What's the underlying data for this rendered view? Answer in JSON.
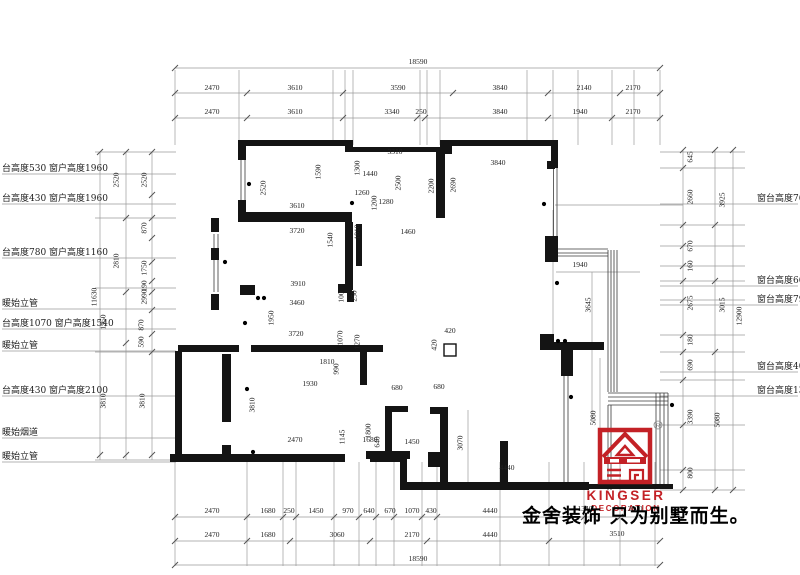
{
  "slogan": "金舍装饰 只为别墅而生。",
  "logo": {
    "brand": "KINGSER",
    "subtitle": "DECORATION",
    "registered": "R",
    "color": "#c32126"
  },
  "dims": {
    "top": [
      {
        "t": "18590",
        "x": 418,
        "y": 62
      },
      {
        "t": "2470",
        "x": 212,
        "y": 88
      },
      {
        "t": "3610",
        "x": 295,
        "y": 88
      },
      {
        "t": "3590",
        "x": 398,
        "y": 88
      },
      {
        "t": "3840",
        "x": 500,
        "y": 88
      },
      {
        "t": "2140",
        "x": 584,
        "y": 88
      },
      {
        "t": "2170",
        "x": 633,
        "y": 88
      },
      {
        "t": "2470",
        "x": 212,
        "y": 112
      },
      {
        "t": "3610",
        "x": 295,
        "y": 112
      },
      {
        "t": "3340",
        "x": 392,
        "y": 112
      },
      {
        "t": "250",
        "x": 421,
        "y": 112
      },
      {
        "t": "3840",
        "x": 500,
        "y": 112
      },
      {
        "t": "1940",
        "x": 580,
        "y": 112
      },
      {
        "t": "2170",
        "x": 633,
        "y": 112
      }
    ],
    "bottom": [
      {
        "t": "2470",
        "x": 212,
        "y": 511
      },
      {
        "t": "1680",
        "x": 268,
        "y": 511
      },
      {
        "t": "250",
        "x": 289,
        "y": 511
      },
      {
        "t": "1450",
        "x": 316,
        "y": 511
      },
      {
        "t": "970",
        "x": 348,
        "y": 511
      },
      {
        "t": "640",
        "x": 369,
        "y": 511
      },
      {
        "t": "670",
        "x": 390,
        "y": 511
      },
      {
        "t": "1070",
        "x": 412,
        "y": 511
      },
      {
        "t": "430",
        "x": 431,
        "y": 511
      },
      {
        "t": "4440",
        "x": 490,
        "y": 511
      },
      {
        "t": "1340",
        "x": 585,
        "y": 509
      },
      {
        "t": "2000",
        "x": 635,
        "y": 509
      },
      {
        "t": "2470",
        "x": 212,
        "y": 535
      },
      {
        "t": "1680",
        "x": 268,
        "y": 535
      },
      {
        "t": "3060",
        "x": 337,
        "y": 535
      },
      {
        "t": "2170",
        "x": 412,
        "y": 535
      },
      {
        "t": "4440",
        "x": 490,
        "y": 535
      },
      {
        "t": "3510",
        "x": 617,
        "y": 534
      },
      {
        "t": "18590",
        "x": 418,
        "y": 559
      }
    ],
    "left": [
      {
        "t": "11630",
        "x": 94,
        "y": 297,
        "r": 1
      },
      {
        "t": "2520",
        "x": 116,
        "y": 180,
        "r": 1
      },
      {
        "t": "2810",
        "x": 116,
        "y": 261,
        "r": 1
      },
      {
        "t": "1950",
        "x": 103,
        "y": 322,
        "r": 1
      },
      {
        "t": "3810",
        "x": 103,
        "y": 401,
        "r": 1
      },
      {
        "t": "2520",
        "x": 144,
        "y": 180,
        "r": 1
      },
      {
        "t": "870",
        "x": 144,
        "y": 228,
        "r": 1
      },
      {
        "t": "1750",
        "x": 144,
        "y": 268,
        "r": 1
      },
      {
        "t": "190",
        "x": 144,
        "y": 286,
        "r": 1
      },
      {
        "t": "2990",
        "x": 144,
        "y": 297,
        "r": 1
      },
      {
        "t": "870",
        "x": 141,
        "y": 325,
        "r": 1
      },
      {
        "t": "590",
        "x": 141,
        "y": 342,
        "r": 1
      },
      {
        "t": "3810",
        "x": 142,
        "y": 401,
        "r": 1
      }
    ],
    "right": [
      {
        "t": "645",
        "x": 690,
        "y": 157,
        "r": 1
      },
      {
        "t": "2660",
        "x": 690,
        "y": 197,
        "r": 1
      },
      {
        "t": "670",
        "x": 690,
        "y": 246,
        "r": 1
      },
      {
        "t": "160",
        "x": 690,
        "y": 266,
        "r": 1
      },
      {
        "t": "2675",
        "x": 690,
        "y": 303,
        "r": 1
      },
      {
        "t": "180",
        "x": 690,
        "y": 340,
        "r": 1
      },
      {
        "t": "690",
        "x": 690,
        "y": 365,
        "r": 1
      },
      {
        "t": "3390",
        "x": 690,
        "y": 417,
        "r": 1
      },
      {
        "t": "800",
        "x": 690,
        "y": 473,
        "r": 1
      },
      {
        "t": "3925",
        "x": 722,
        "y": 200,
        "r": 1
      },
      {
        "t": "3015",
        "x": 722,
        "y": 305,
        "r": 1
      },
      {
        "t": "5080",
        "x": 717,
        "y": 420,
        "r": 1
      },
      {
        "t": "12900",
        "x": 739,
        "y": 316,
        "r": 1
      }
    ],
    "interior": [
      {
        "t": "3310",
        "x": 395,
        "y": 152
      },
      {
        "t": "3840",
        "x": 498,
        "y": 163
      },
      {
        "t": "1440",
        "x": 370,
        "y": 174
      },
      {
        "t": "1260",
        "x": 362,
        "y": 193
      },
      {
        "t": "1280",
        "x": 386,
        "y": 202
      },
      {
        "t": "3610",
        "x": 297,
        "y": 206
      },
      {
        "t": "3720",
        "x": 297,
        "y": 231
      },
      {
        "t": "1460",
        "x": 408,
        "y": 232
      },
      {
        "t": "3910",
        "x": 298,
        "y": 284
      },
      {
        "t": "3460",
        "x": 297,
        "y": 303
      },
      {
        "t": "3720",
        "x": 296,
        "y": 334
      },
      {
        "t": "1810",
        "x": 327,
        "y": 362
      },
      {
        "t": "1930",
        "x": 310,
        "y": 384
      },
      {
        "t": "680",
        "x": 397,
        "y": 388
      },
      {
        "t": "680",
        "x": 439,
        "y": 387
      },
      {
        "t": "2470",
        "x": 295,
        "y": 440
      },
      {
        "t": "1680",
        "x": 370,
        "y": 440
      },
      {
        "t": "1450",
        "x": 412,
        "y": 442
      },
      {
        "t": "4440",
        "x": 507,
        "y": 468
      },
      {
        "t": "1940",
        "x": 580,
        "y": 265
      },
      {
        "t": "420",
        "x": 450,
        "y": 331
      },
      {
        "t": "2520",
        "x": 263,
        "y": 188,
        "r": 1
      },
      {
        "t": "1590",
        "x": 318,
        "y": 172,
        "r": 1
      },
      {
        "t": "1300",
        "x": 357,
        "y": 168,
        "r": 1
      },
      {
        "t": "1200",
        "x": 374,
        "y": 203,
        "r": 1
      },
      {
        "t": "2500",
        "x": 398,
        "y": 183,
        "r": 1
      },
      {
        "t": "2200",
        "x": 431,
        "y": 186,
        "r": 1
      },
      {
        "t": "2690",
        "x": 453,
        "y": 185,
        "r": 1
      },
      {
        "t": "1540",
        "x": 330,
        "y": 240,
        "r": 1
      },
      {
        "t": "1810",
        "x": 357,
        "y": 232,
        "r": 1
      },
      {
        "t": "250",
        "x": 354,
        "y": 296,
        "r": 1
      },
      {
        "t": "100",
        "x": 341,
        "y": 297,
        "r": 1
      },
      {
        "t": "1950",
        "x": 271,
        "y": 318,
        "r": 1
      },
      {
        "t": "1070",
        "x": 340,
        "y": 338,
        "r": 1
      },
      {
        "t": "1270",
        "x": 357,
        "y": 342,
        "r": 1
      },
      {
        "t": "990",
        "x": 336,
        "y": 369,
        "r": 1
      },
      {
        "t": "3810",
        "x": 252,
        "y": 405,
        "r": 1
      },
      {
        "t": "1145",
        "x": 342,
        "y": 437,
        "r": 1
      },
      {
        "t": "1800",
        "x": 368,
        "y": 431,
        "r": 1
      },
      {
        "t": "640",
        "x": 377,
        "y": 442,
        "r": 1
      },
      {
        "t": "420",
        "x": 434,
        "y": 345,
        "r": 1
      },
      {
        "t": "3070",
        "x": 460,
        "y": 443,
        "r": 1
      },
      {
        "t": "5080",
        "x": 593,
        "y": 418,
        "r": 1
      },
      {
        "t": "3645",
        "x": 588,
        "y": 305,
        "r": 1
      }
    ]
  },
  "side_notes": {
    "left": [
      {
        "t": "台高度530 窗户高度1960",
        "x": 2,
        "y": 168
      },
      {
        "t": "台高度430 窗户高度1960",
        "x": 2,
        "y": 198
      },
      {
        "t": "台高度780 窗户高度1160",
        "x": 2,
        "y": 252
      },
      {
        "t": "暖始立管",
        "x": 2,
        "y": 303
      },
      {
        "t": "台高度1070 窗户高度1540",
        "x": 2,
        "y": 323
      },
      {
        "t": "暖始立管",
        "x": 2,
        "y": 345
      },
      {
        "t": "台高度430 窗户高度2100",
        "x": 2,
        "y": 390
      },
      {
        "t": "暖始烟道",
        "x": 2,
        "y": 432
      },
      {
        "t": "暖始立管",
        "x": 2,
        "y": 456
      }
    ],
    "right": [
      {
        "t": "窗台高度760",
        "x": 757,
        "y": 198
      },
      {
        "t": "窗台高度660",
        "x": 757,
        "y": 280
      },
      {
        "t": "窗台高度790",
        "x": 757,
        "y": 299
      },
      {
        "t": "窗台高度400",
        "x": 757,
        "y": 366
      },
      {
        "t": "窗台高度1300",
        "x": 757,
        "y": 390
      }
    ]
  }
}
